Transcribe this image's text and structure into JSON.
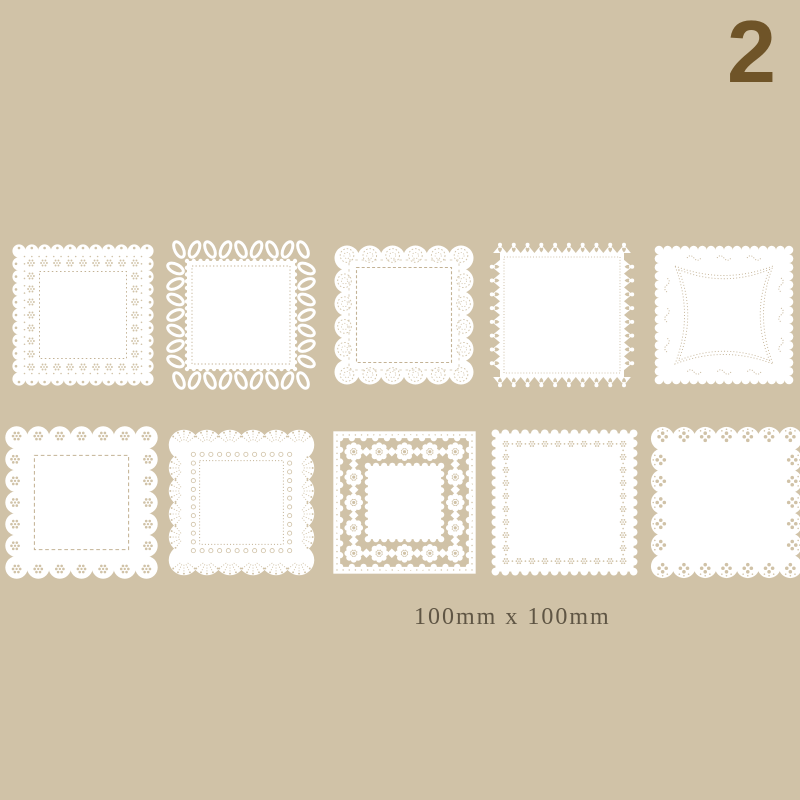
{
  "badge": {
    "number": "2",
    "color": "#6f5428"
  },
  "caption": {
    "text": "100mm x 100mm",
    "color": "#5f5544"
  },
  "colors": {
    "background": "#d0c2a7",
    "doily_white": "#ffffff",
    "lace_hole": "#d0c2a7",
    "stitch": "#c3b295"
  },
  "doilies": {
    "count": 10,
    "item_description": "white square lace paper doilies arranged in 2 rows of 5",
    "items": [
      {
        "id": 1,
        "row": 1,
        "col": 1,
        "variant": "eyelet-scallop",
        "description": "small scalloped edge with eyelet flower perforations and dotted inner square"
      },
      {
        "id": 2,
        "row": 1,
        "col": 2,
        "variant": "loop-lace",
        "description": "open ribbon-loop border around dotted square"
      },
      {
        "id": 3,
        "row": 1,
        "col": 3,
        "variant": "dotted-medallion-scallop",
        "description": "large round scallops with dotted medallion circles and dashed inner square"
      },
      {
        "id": 4,
        "row": 1,
        "col": 4,
        "variant": "heart-picot",
        "description": "pointed scallops with heart cutouts"
      },
      {
        "id": 5,
        "row": 1,
        "col": 5,
        "variant": "curved-dot-frame",
        "description": "small scalloped edge with curvy perforated double frame"
      },
      {
        "id": 6,
        "row": 2,
        "col": 1,
        "variant": "daisy-medallion-scallop",
        "description": "round scallops with daisy cutouts and dashed inner square"
      },
      {
        "id": 7,
        "row": 2,
        "col": 2,
        "variant": "fan-shell",
        "description": "fan shell scallops with radiating perforations and eyelet ring"
      },
      {
        "id": 8,
        "row": 2,
        "col": 3,
        "variant": "openwork-flower-band",
        "description": "straight edge with openwork flower lattice band"
      },
      {
        "id": 9,
        "row": 2,
        "col": 4,
        "variant": "flower-dot-border",
        "description": "gently scalloped edge with flower-and-dot perforated border"
      },
      {
        "id": 10,
        "row": 2,
        "col": 5,
        "variant": "clover-scallop",
        "description": "round scallops with clover dot cutouts"
      }
    ]
  }
}
